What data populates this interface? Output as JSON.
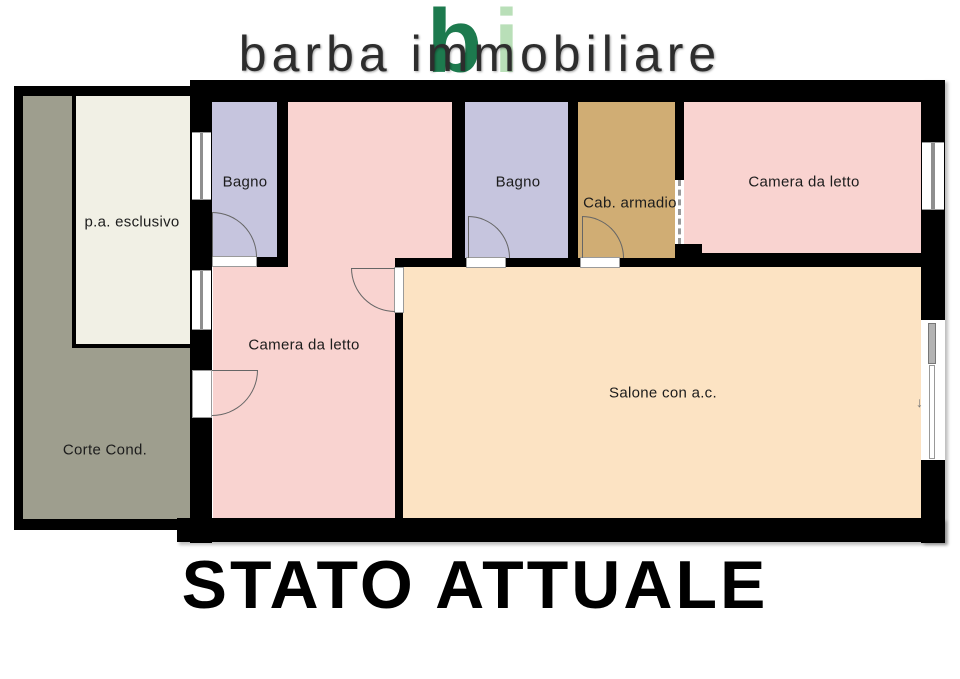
{
  "logo": {
    "text": "barba immobiliare",
    "monogram_b": "b",
    "monogram_i": "i"
  },
  "title": "STATO ATTUALE",
  "rooms": {
    "bagno_left": {
      "label": "Bagno"
    },
    "bagno_right": {
      "label": "Bagno"
    },
    "cab_armadio": {
      "label": "Cab. armadio"
    },
    "camera_right": {
      "label": "Camera da letto"
    },
    "camera_left": {
      "label": "Camera da letto"
    },
    "salone": {
      "label": "Salone con a.c."
    },
    "pa_esclusivo": {
      "label": "p.a. esclusivo"
    },
    "corte": {
      "label": "Corte Cond."
    }
  },
  "icons": {
    "slide_arrow": "↓"
  },
  "colors": {
    "bagno": "#c6c5de",
    "camera": "#f9d3d0",
    "cab": "#d0ad74",
    "salone": "#fce3c3",
    "corte": "#9e9e8e",
    "pa": "#f1f0e5",
    "wall": "#000000",
    "logo_b": "#1d7a4e",
    "logo_i": "#b9dfb8"
  }
}
